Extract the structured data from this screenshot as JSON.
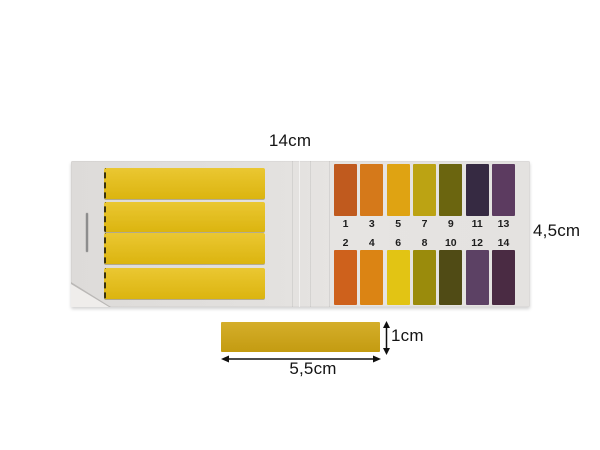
{
  "annotations": {
    "width_label": "14cm",
    "height_label": "4,5cm",
    "strip_length_label": "5,5cm",
    "strip_thickness_label": "1cm"
  },
  "booklet": {
    "strip_color": "#E7BE10"
  },
  "single_strip": {
    "color": "#D0A512"
  },
  "ph_scale": {
    "top_row": [
      {
        "value": "1",
        "color": "#C05A1E"
      },
      {
        "value": "3",
        "color": "#D5791A"
      },
      {
        "value": "5",
        "color": "#DFA312"
      },
      {
        "value": "7",
        "color": "#BCA313"
      },
      {
        "value": "9",
        "color": "#6B650F"
      },
      {
        "value": "11",
        "color": "#362A42"
      },
      {
        "value": "13",
        "color": "#5C3B60"
      }
    ],
    "bottom_row": [
      {
        "value": "2",
        "color": "#CE611C"
      },
      {
        "value": "4",
        "color": "#DB8414"
      },
      {
        "value": "6",
        "color": "#E2C414"
      },
      {
        "value": "8",
        "color": "#9A8B0C"
      },
      {
        "value": "10",
        "color": "#504B15"
      },
      {
        "value": "12",
        "color": "#5C4164"
      },
      {
        "value": "14",
        "color": "#4A2B43"
      }
    ]
  }
}
